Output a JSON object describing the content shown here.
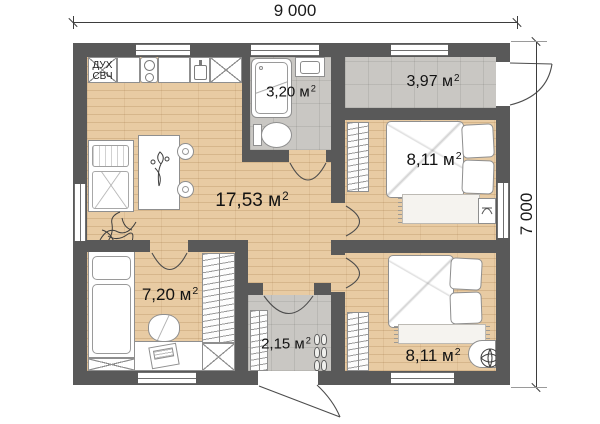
{
  "dimensions": {
    "width_label": "9 000",
    "height_label": "7 000"
  },
  "rooms": {
    "living": {
      "area": "17,53 м",
      "area_sup": "2"
    },
    "bathroom": {
      "area": "3,20 м",
      "area_sup": "2"
    },
    "entry_top": {
      "area": "3,97 м",
      "area_sup": "2"
    },
    "bedroom_top": {
      "area": "8,11 м",
      "area_sup": "2"
    },
    "bedroom_bottom": {
      "area": "8,11 м",
      "area_sup": "2"
    },
    "kids_room": {
      "area": "7,20 м",
      "area_sup": "2"
    },
    "entry_bottom": {
      "area": "2,15 м",
      "area_sup": "2"
    }
  },
  "kitchen": {
    "oven": "ДУХ",
    "microwave": "СВЧ"
  },
  "colors": {
    "wall": "#595959",
    "wood_floor": "#e8cba3",
    "tile_floor": "#c9c7c3"
  }
}
